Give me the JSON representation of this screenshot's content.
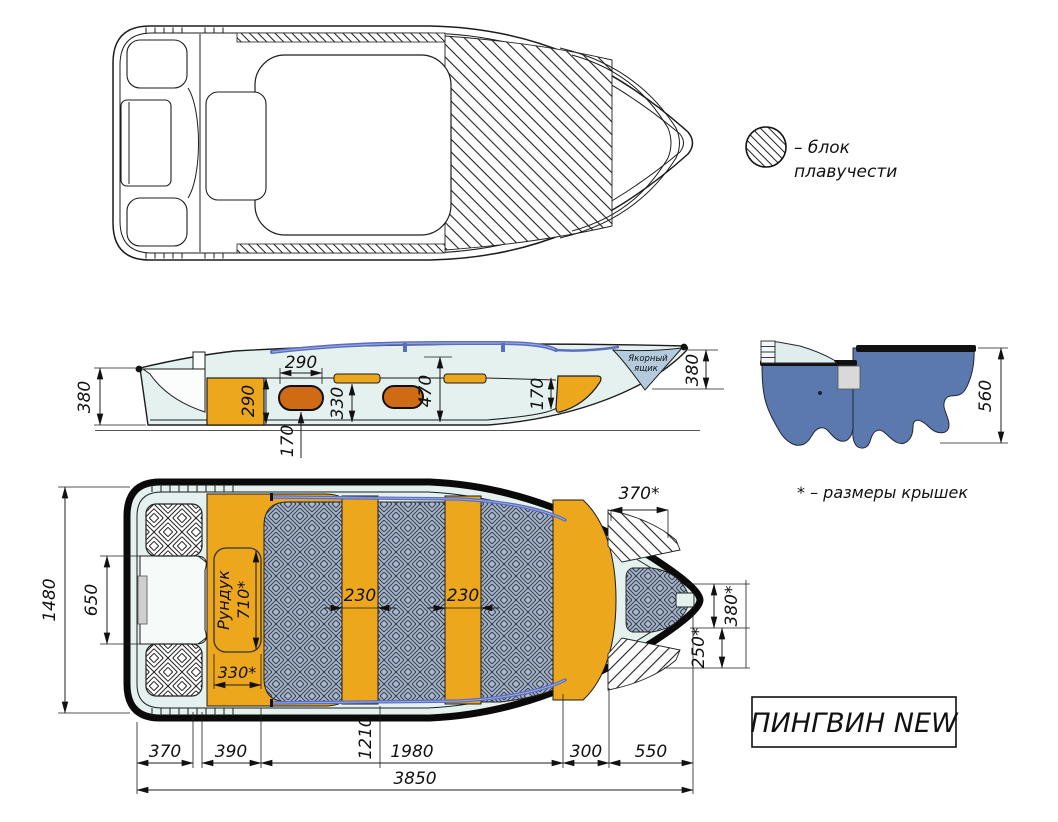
{
  "title_block": {
    "model": "ПИНГВИН NEW"
  },
  "legend": {
    "line1": "– блок",
    "line2": "плавучести"
  },
  "note_covers": "* – размеры крышек",
  "side_view": {
    "anchor_box": {
      "line1": "Якорный",
      "line2": "ящик"
    },
    "dims": {
      "stern_height": "380",
      "bench_height": "290",
      "tank_width": "290",
      "tank_offset": "170",
      "shelf_height": "330",
      "cockpit_depth": "470",
      "bow_locker_height": "170",
      "bow_height": "380"
    }
  },
  "section_view": {
    "dims": {
      "hull_depth": "560"
    }
  },
  "plan_view": {
    "locker_label": "Рундук",
    "dims": {
      "beam": "1480",
      "transom_width": "650",
      "locker_length": "710*",
      "locker_width": "330*",
      "bench_front_width": "230",
      "bench_mid_width": "230",
      "bow_hatch_width": "370*",
      "bow_hatch_length": "380*",
      "bow_hatch_side": "250*"
    }
  },
  "length_chain": {
    "dims": {
      "stern_overhang": "370",
      "stern_section": "390",
      "transom_to_bench": "1210",
      "cockpit_length": "1980",
      "bow_section": "300",
      "bow_overhang": "550",
      "overall_length": "3850"
    }
  },
  "colors": {
    "hull_fill": "#e4f1ee",
    "bench_orange": "#eda71c",
    "tank_orange": "#cf6b15",
    "floor_blue": "#aab9cf",
    "rail_blue": "#5a6ec0",
    "section_blue": "#5b79ae",
    "anchor_box_blue": "#b3cbdc"
  }
}
